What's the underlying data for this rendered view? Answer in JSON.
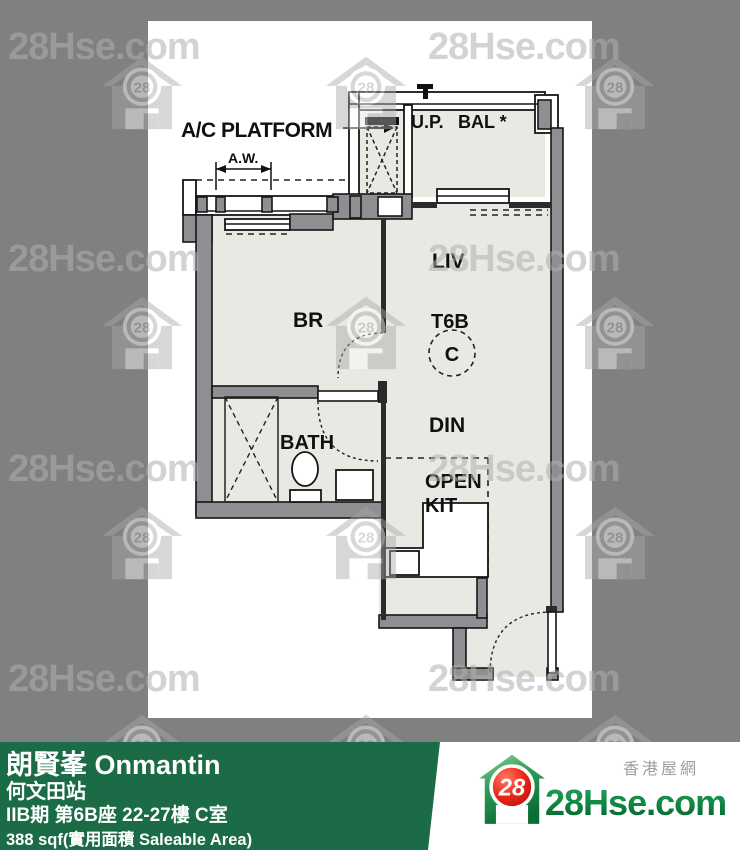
{
  "watermark": {
    "text": "28Hse.com",
    "badge": "28"
  },
  "plan": {
    "labels": {
      "ac_platform": "A/C PLATFORM",
      "aw": "A.W.",
      "up": "U.P.",
      "bal": "BAL *",
      "liv": "LIV",
      "br": "BR",
      "t6b": "T6B",
      "unit_letter": "C",
      "din": "DIN",
      "bath": "BATH",
      "open": "OPEN",
      "kit": "KIT"
    }
  },
  "footer": {
    "bar_color": "#1a6b46",
    "estate_name": "朗賢峯 Onmantin",
    "station": "何文田站",
    "unit_info": "IIB期 第6B座 22-27樓 C室",
    "area_info": "388 sqf(實用面積 Saleable Area)"
  },
  "brand": {
    "site_chinese": "香港屋網",
    "site_name": "28Hse.com",
    "badge": "28",
    "brand_green": "#0d7b3e",
    "brand_red": "#d41414"
  }
}
